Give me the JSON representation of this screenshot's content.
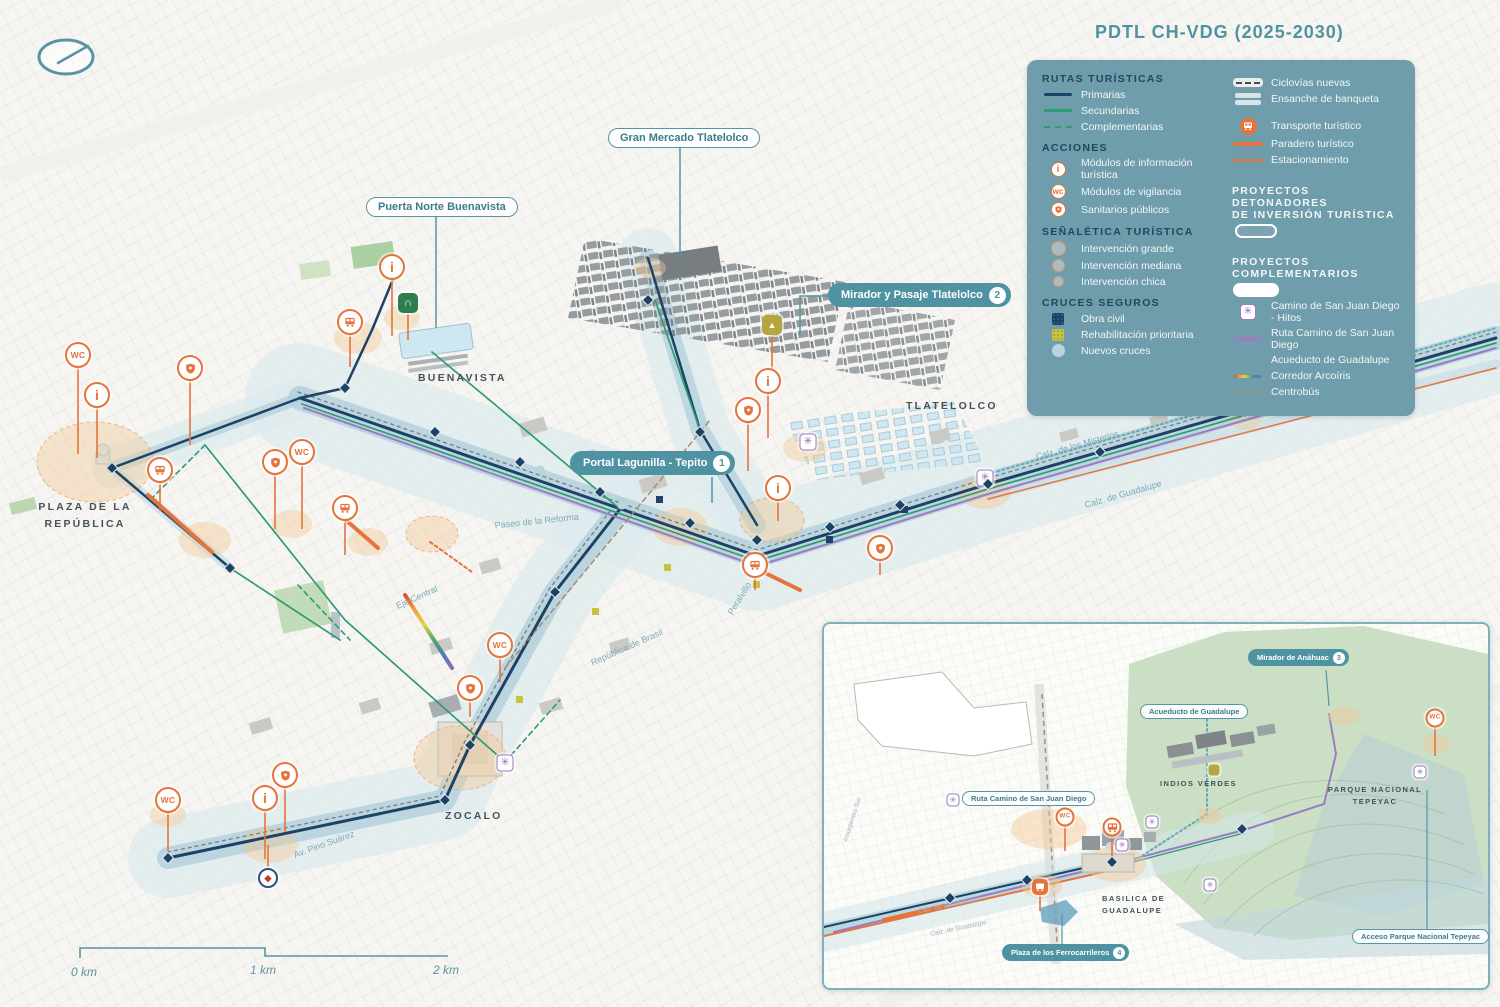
{
  "title": "PDTL CH-VDG (2025-2030)",
  "legend": {
    "rutas": {
      "heading": "RUTAS TURÍSTICAS",
      "items": [
        {
          "label": "Primarias"
        },
        {
          "label": "Secundarias"
        },
        {
          "label": "Complementarias"
        }
      ]
    },
    "acciones": {
      "heading": "ACCIONES",
      "items": [
        {
          "label": "Módulos de información turística"
        },
        {
          "label": "Módulos de vigilancia"
        },
        {
          "label": "Sanitarios públicos"
        }
      ]
    },
    "senaletica": {
      "heading": "SEÑALÉTICA TURÍSTICA",
      "items": [
        {
          "label": "Intervención grande"
        },
        {
          "label": "Intervención mediana"
        },
        {
          "label": "Intervención chica"
        }
      ]
    },
    "cruces": {
      "heading": "CRUCES SEGUROS",
      "items": [
        {
          "label": "Obra civil"
        },
        {
          "label": "Rehabilitación prioritaria"
        },
        {
          "label": "Nuevos cruces"
        }
      ]
    },
    "movilidad": {
      "items": [
        {
          "label": "Ciclovías nuevas"
        },
        {
          "label": "Ensanche de banqueta"
        },
        {
          "label": "Transporte turístico"
        },
        {
          "label": "Paradero turístico"
        },
        {
          "label": "Estacionamiento"
        }
      ]
    },
    "detonadores": {
      "heading_line1": "PROYECTOS DETONADORES",
      "heading_line2": "DE INVERSIÓN TURÍSTICA"
    },
    "complementarios": {
      "heading": "PROYECTOS COMPLEMENTARIOS",
      "items": [
        {
          "label": "Camino de San Juan Diego - Hitos"
        },
        {
          "label": "Ruta Camino de San Juan Diego"
        },
        {
          "label": "Acueducto de Guadalupe"
        },
        {
          "label": "Corredor Arcoíris"
        },
        {
          "label": "Centrobús"
        }
      ]
    }
  },
  "callouts": {
    "gran_mercado": {
      "label": "Gran Mercado Tlatelolco"
    },
    "puerta_norte": {
      "label": "Puerta Norte Buenavista"
    },
    "mirador_tlatelolco": {
      "label": "Mirador y Pasaje Tlatelolco",
      "badge": "2"
    },
    "portal_lagunilla": {
      "label": "Portal Lagunilla - Tepito",
      "badge": "1"
    },
    "mirador_anahuac": {
      "label": "Mirador de Anáhuac",
      "badge": "3"
    },
    "acueducto_guadalupe": {
      "label": "Acueducto de Guadalupe"
    },
    "ruta_camino": {
      "label": "Ruta Camino de San Juan Diego"
    },
    "plaza_ferrocarrileros": {
      "label": "Plaza de los Ferrocarrileros",
      "badge": "4"
    },
    "acceso_parque": {
      "label": "Acceso Parque Nacional Tepeyac"
    }
  },
  "areas": {
    "buenavista": "BUENAVISTA",
    "tlatelolco": "TLATELOLCO",
    "plaza_republica_1": "PLAZA DE LA",
    "plaza_republica_2": "REPÚBLICA",
    "zocalo": "ZOCALO",
    "indios_verdes": "INDIOS VERDES",
    "parque_tepeyac_1": "PARQUE NACIONAL",
    "parque_tepeyac_2": "TEPEYAC",
    "basilica_1": "BASILICA DE",
    "basilica_2": "GUADALUPE"
  },
  "streets": {
    "reforma": "Paseo de la Reforma",
    "eje_central": "Eje Central",
    "brasil": "República de Brasil",
    "peralvillo": "Peralvillo",
    "misterios": "Calz. de los Misterios",
    "guadalupe": "Calz. de Guadalupe",
    "pino_suarez": "Av. Pino Suárez",
    "insurgentes": "Insurgentes Sur",
    "misterios_inset": "Calz. de los Misterios",
    "guadalupe_inset": "Calz. de Guadalupe"
  },
  "scalebar": {
    "k0": "0 km",
    "k1": "1 km",
    "k2": "2 km"
  },
  "glyphs": {
    "wc": "WC",
    "wc_small": "wc",
    "info": "i",
    "flower": "✳",
    "door": "∩",
    "pyramid": "▲",
    "emblem": "◆"
  },
  "colors": {
    "accent_teal": "#4f93a3",
    "panel": "#6f9dab",
    "heading_navy": "#24465f",
    "primary_route": "#1d4265",
    "secondary_route": "#2f9b72",
    "orange": "#e4743c",
    "purple": "#9b7cc0",
    "aqueduct": "#64a9b5",
    "crossing_yellow": "#c8c23f",
    "rainbow": [
      "#d94f3c",
      "#e8a33c",
      "#e8d34b",
      "#58a965",
      "#4a7fb5",
      "#8e6bb0"
    ]
  },
  "map_icons": [
    {
      "t": "wc",
      "x": 78,
      "y": 355,
      "s": 88
    },
    {
      "t": "info",
      "x": 97,
      "y": 395,
      "s": 52
    },
    {
      "t": "shield",
      "x": 190,
      "y": 368,
      "s": 66
    },
    {
      "t": "bus",
      "x": 160,
      "y": 470,
      "s": 30
    },
    {
      "t": "shield",
      "x": 275,
      "y": 462,
      "s": 56
    },
    {
      "t": "wc",
      "x": 302,
      "y": 452,
      "s": 66
    },
    {
      "t": "bus",
      "x": 345,
      "y": 508,
      "s": 36
    },
    {
      "t": "info",
      "x": 392,
      "y": 267,
      "s": 58
    },
    {
      "t": "bus",
      "x": 350,
      "y": 322,
      "s": 34
    },
    {
      "t": "door",
      "x": 408,
      "y": 303,
      "s": 26
    },
    {
      "t": "pyramid",
      "x": 772,
      "y": 325,
      "s": 42
    },
    {
      "t": "info",
      "x": 768,
      "y": 381,
      "s": 46
    },
    {
      "t": "shield",
      "x": 748,
      "y": 410,
      "s": 50
    },
    {
      "t": "info",
      "x": 778,
      "y": 488,
      "s": 22
    },
    {
      "t": "bus",
      "x": 755,
      "y": 565,
      "s": 14
    },
    {
      "t": "shield",
      "x": 880,
      "y": 548,
      "s": 16
    },
    {
      "t": "wc",
      "x": 500,
      "y": 645,
      "s": 26
    },
    {
      "t": "shield",
      "x": 470,
      "y": 688,
      "s": 18
    },
    {
      "t": "wc",
      "x": 168,
      "y": 800,
      "s": 40
    },
    {
      "t": "shield",
      "x": 285,
      "y": 775,
      "s": 46
    },
    {
      "t": "info",
      "x": 265,
      "y": 798,
      "s": 50
    },
    {
      "t": "emblem",
      "x": 268,
      "y": 878,
      "s": -22
    },
    {
      "t": "flower",
      "x": 808,
      "y": 442,
      "s": 0
    },
    {
      "t": "flower",
      "x": 985,
      "y": 478,
      "s": 0
    },
    {
      "t": "flower",
      "x": 505,
      "y": 763,
      "s": 0
    },
    {
      "t": "wc",
      "x": 1065,
      "y": 817,
      "s": 26,
      "sm": true
    },
    {
      "t": "bus",
      "x": 1112,
      "y": 827,
      "s": 24,
      "sm": true
    },
    {
      "t": "busfill",
      "x": 1040,
      "y": 887,
      "s": 16,
      "sm": true
    },
    {
      "t": "wc",
      "x": 1435,
      "y": 718,
      "s": 30,
      "sm": true
    },
    {
      "t": "flower",
      "x": 953,
      "y": 800,
      "s": 0,
      "sm": true
    },
    {
      "t": "flower",
      "x": 1152,
      "y": 822,
      "s": 0,
      "sm": true
    },
    {
      "t": "flower",
      "x": 1122,
      "y": 845,
      "s": 0,
      "sm": true
    },
    {
      "t": "flower",
      "x": 1210,
      "y": 885,
      "s": 0,
      "sm": true
    },
    {
      "t": "flower",
      "x": 1420,
      "y": 772,
      "s": 0,
      "sm": true
    },
    {
      "t": "metro",
      "x": 1214,
      "y": 770,
      "s": 0,
      "sm": true
    }
  ],
  "stations": [
    [
      345,
      388
    ],
    [
      435,
      432
    ],
    [
      520,
      462
    ],
    [
      600,
      492
    ],
    [
      690,
      523
    ],
    [
      757,
      540
    ],
    [
      830,
      527
    ],
    [
      900,
      505
    ],
    [
      988,
      484
    ],
    [
      1100,
      452
    ],
    [
      1245,
      412
    ],
    [
      1390,
      369
    ],
    [
      648,
      300
    ],
    [
      700,
      432
    ],
    [
      555,
      592
    ],
    [
      470,
      745
    ],
    [
      445,
      800
    ],
    [
      230,
      568
    ],
    [
      112,
      468
    ],
    [
      168,
      858
    ],
    [
      950,
      898
    ],
    [
      1027,
      880
    ],
    [
      1112,
      862
    ],
    [
      1242,
      829
    ]
  ]
}
